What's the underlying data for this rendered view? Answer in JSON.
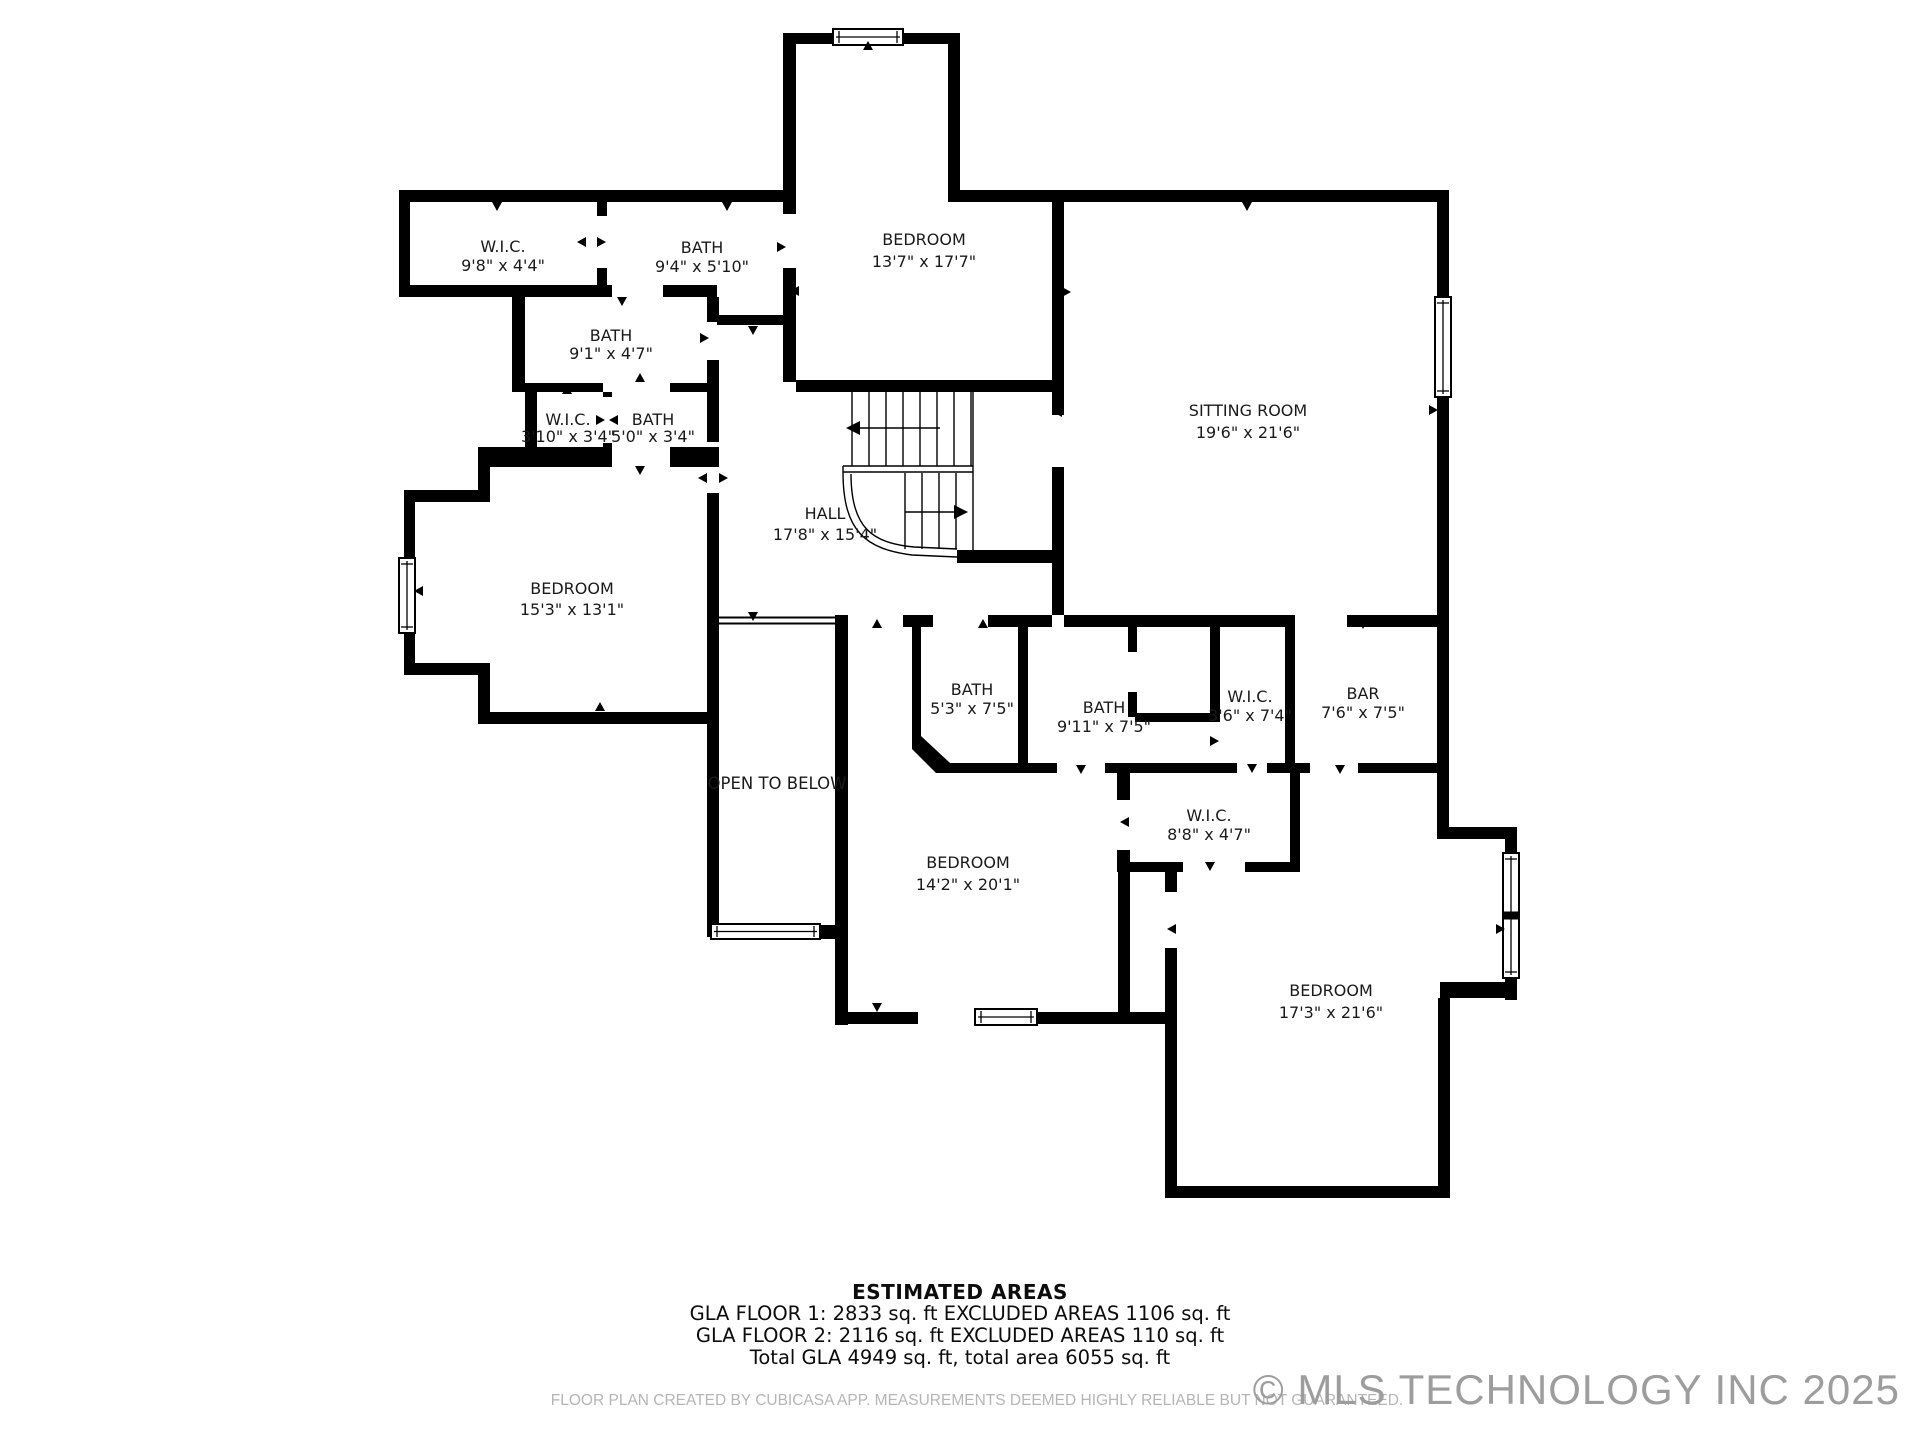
{
  "plan": {
    "wall_color": "#000000",
    "background": "#ffffff",
    "floor_label": "Floor 2 plan"
  },
  "rooms": [
    {
      "name": "W.I.C.",
      "dims": "9'8\" x 4'4\""
    },
    {
      "name": "BATH",
      "dims": "9'4\" x 5'10\""
    },
    {
      "name": "BEDROOM",
      "dims": "13'7\" x 17'7\""
    },
    {
      "name": "BATH",
      "dims": "9'1\" x 4'7\""
    },
    {
      "name": "W.I.C.",
      "dims": "3'10\" x 3'4\""
    },
    {
      "name": "BATH",
      "dims": "5'0\" x 3'4\""
    },
    {
      "name": "BEDROOM",
      "dims": "15'3\" x 13'1\""
    },
    {
      "name": "HALL",
      "dims": "17'8\" x 15'4\""
    },
    {
      "name": "SITTING ROOM",
      "dims": "19'6\" x 21'6\""
    },
    {
      "name": "BATH",
      "dims": "5'3\" x 7'5\""
    },
    {
      "name": "BATH",
      "dims": "9'11\" x 7'5\""
    },
    {
      "name": "W.I.C.",
      "dims": "3'6\" x 7'4\""
    },
    {
      "name": "BAR",
      "dims": "7'6\" x 7'5\""
    },
    {
      "name": "W.I.C.",
      "dims": "8'8\" x 4'7\""
    },
    {
      "name": "BEDROOM",
      "dims": "14'2\" x 20'1\""
    },
    {
      "name": "BEDROOM",
      "dims": "17'3\" x 21'6\""
    }
  ],
  "annotations": {
    "open_to_below": "OPEN TO BELOW"
  },
  "estimated_areas": {
    "title": "ESTIMATED AREAS",
    "floor1": "GLA FLOOR 1: 2833 sq. ft EXCLUDED AREAS 1106 sq. ft",
    "floor2": "GLA FLOOR 2: 2116 sq. ft EXCLUDED AREAS 110 sq. ft",
    "total": "Total GLA 4949 sq. ft, total area 6055 sq. ft"
  },
  "footer": {
    "disclaimer": "FLOOR PLAN CREATED BY CUBICASA APP. MEASUREMENTS DEEMED HIGHLY RELIABLE BUT NOT GUARANTEED.",
    "watermark": "© MLS TECHNOLOGY INC 2025"
  }
}
